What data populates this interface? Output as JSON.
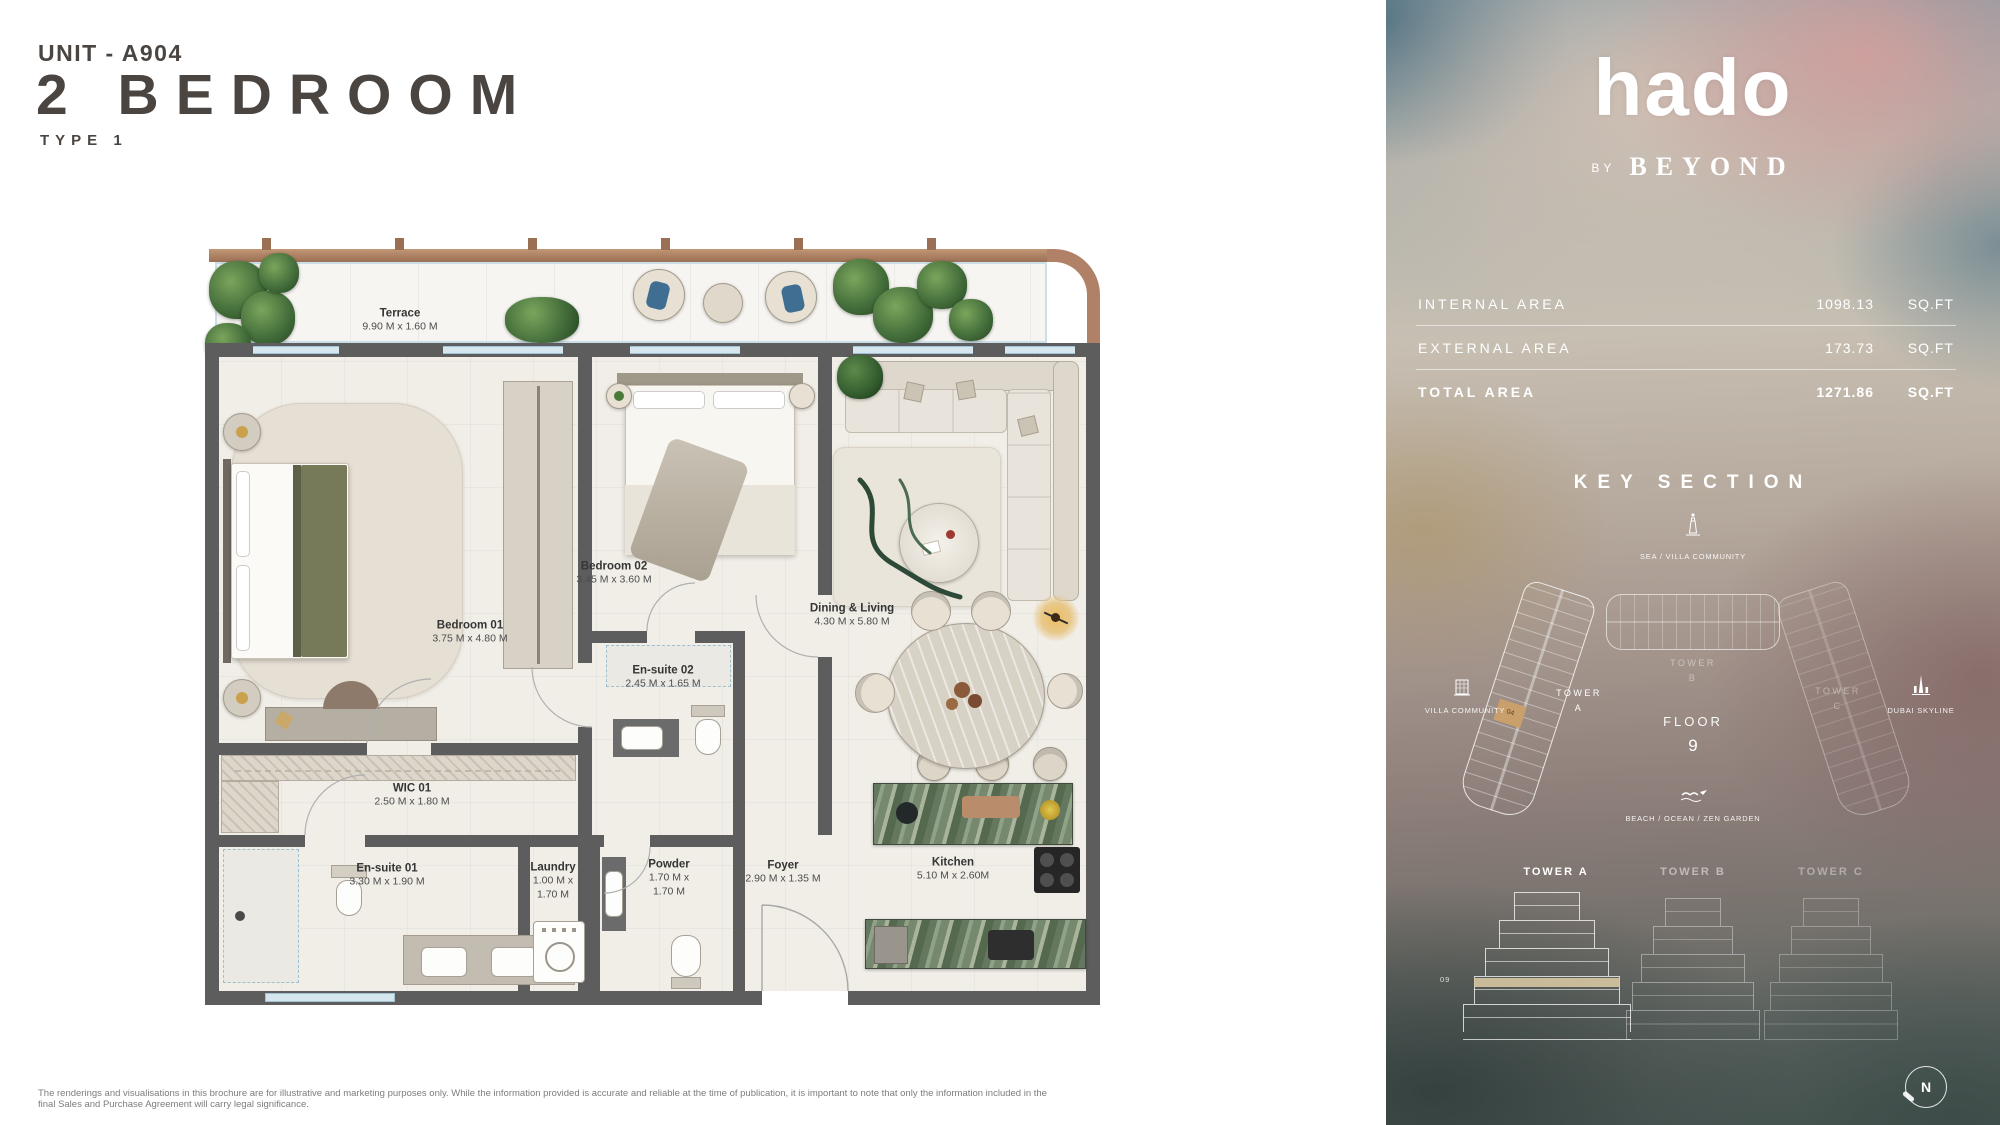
{
  "page": {
    "unit_label": "UNIT - A904",
    "title": "2 BEDROOM",
    "type_label": "TYPE 1",
    "disclaimer": "The renderings and visualisations in this brochure are for illustrative and marketing purposes only. While the information provided is accurate and reliable at the time of publication, it is important to note that only the information included in the final Sales and Purchase Agreement will carry legal significance."
  },
  "brand": {
    "logo": "hado",
    "by_label": "BY",
    "developer": "BEYOND"
  },
  "areas": {
    "rows": [
      {
        "label": "INTERNAL AREA",
        "value": "1098.13",
        "unit": "SQ.FT"
      },
      {
        "label": "EXTERNAL AREA",
        "value": "173.73",
        "unit": "SQ.FT"
      },
      {
        "label": "TOTAL AREA",
        "value": "1271.86",
        "unit": "SQ.FT"
      }
    ]
  },
  "key_section": {
    "title": "KEY SECTION",
    "sea_label": "SEA / VILLA COMMUNITY",
    "villa_label": "VILLA COMMUNITY",
    "skyline_label": "DUBAI SKYLINE",
    "beach_label": "BEACH / OCEAN / ZEN GARDEN",
    "floor_label": "FLOOR",
    "floor_number": "9",
    "unit_cell": "04",
    "floor_badge": "09",
    "compass_letter": "N",
    "tower_a": {
      "word": "TOWER",
      "letter": "A"
    },
    "tower_b": {
      "word": "TOWER",
      "letter": "B"
    },
    "tower_c": {
      "word": "TOWER",
      "letter": "C"
    },
    "elevation_labels": [
      "TOWER A",
      "TOWER B",
      "TOWER C"
    ]
  },
  "floor_plan": {
    "rooms": [
      {
        "name": "Terrace",
        "dims": "9.90 M x 1.60 M"
      },
      {
        "name": "Bedroom 01",
        "dims": "3.75 M x 4.80 M"
      },
      {
        "name": "Bedroom 02",
        "dims": "3.45 M x 3.60 M"
      },
      {
        "name": "En-suite 02",
        "dims": "2.45 M x 1.65 M"
      },
      {
        "name": "WIC 01",
        "dims": "2.50 M x 1.80 M"
      },
      {
        "name": "En-suite 01",
        "dims": "3.30 M x 1.90 M"
      },
      {
        "name": "Laundry",
        "dims": "1.00 M x 1.70 M"
      },
      {
        "name": "Powder",
        "dims": "1.70 M x 1.70 M"
      },
      {
        "name": "Foyer",
        "dims": "2.90 M x 1.35 M"
      },
      {
        "name": "Kitchen",
        "dims": "5.10 M x 2.60M"
      },
      {
        "name": "Dining & Living",
        "dims": "4.30 M x 5.80 M"
      }
    ]
  },
  "colors": {
    "copper_railing": "#b08166",
    "wall_grey": "#5d5d5d",
    "kitchen_marble_green": "#6e8168",
    "highlight_unit_tan": "#c9a06b",
    "title_text": "#4b4542"
  }
}
